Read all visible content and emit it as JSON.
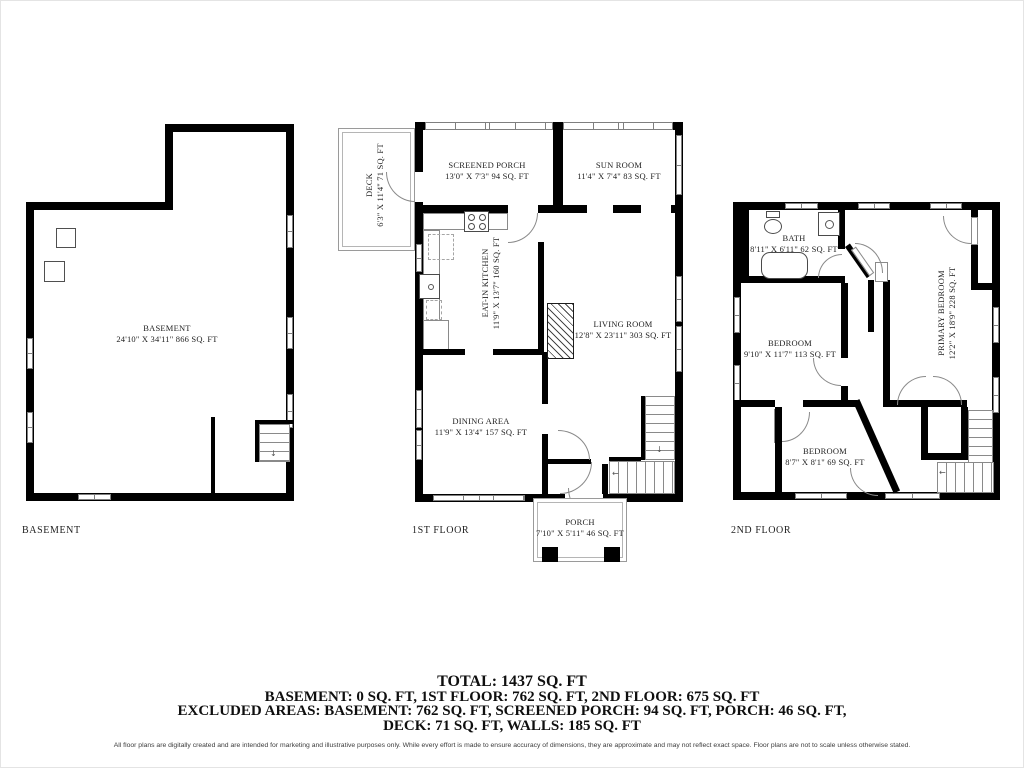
{
  "colors": {
    "wall": "#000000",
    "window_frame": "#7f7f7f",
    "text": "#1f1f1f"
  },
  "plans": {
    "basement": {
      "caption": "BASEMENT",
      "room": {
        "name": "BASEMENT",
        "dims": "24'10\" X 34'11\" 866 SQ. FT"
      }
    },
    "first_floor": {
      "caption": "1ST FLOOR",
      "rooms": {
        "deck": {
          "name": "DECK",
          "dims": "6'3\" X 11'4\" 71 SQ. FT"
        },
        "screened_porch": {
          "name": "SCREENED PORCH",
          "dims": "13'0\" X 7'3\" 94 SQ. FT"
        },
        "sun_room": {
          "name": "SUN ROOM",
          "dims": "11'4\" X 7'4\" 83 SQ. FT"
        },
        "kitchen": {
          "name": "EAT-IN KITCHEN",
          "dims": "11'9\" X 13'7\" 160 SQ. FT"
        },
        "living_room": {
          "name": "LIVING ROOM",
          "dims": "12'8\" X 23'11\" 303 SQ. FT"
        },
        "dining_area": {
          "name": "DINING AREA",
          "dims": "11'9\" X 13'4\" 157 SQ. FT"
        },
        "porch": {
          "name": "PORCH",
          "dims": "7'10\" X 5'11\" 46 SQ. FT"
        }
      }
    },
    "second_floor": {
      "caption": "2ND FLOOR",
      "rooms": {
        "bath": {
          "name": "BATH",
          "dims": "8'11\" X 6'11\" 62 SQ. FT"
        },
        "bedroom_left": {
          "name": "BEDROOM",
          "dims": "9'10\" X 11'7\" 113 SQ. FT"
        },
        "primary_bedroom": {
          "name": "PRIMARY BEDROOM",
          "dims": "12'2\" X 18'9\" 228 SQ. FT"
        },
        "bedroom_bottom": {
          "name": "BEDROOM",
          "dims": "8'7\" X 8'1\" 69 SQ. FT"
        }
      }
    }
  },
  "glyphs": {
    "down_arrow": "↓",
    "left_arrow": "←"
  },
  "summary": {
    "total": "TOTAL: 1437 SQ. FT",
    "floors": "BASEMENT: 0 SQ. FT, 1ST FLOOR: 762 SQ. FT, 2ND FLOOR: 675 SQ. FT",
    "excluded_1": "EXCLUDED AREAS: BASEMENT: 762 SQ. FT, SCREENED PORCH: 94 SQ. FT, PORCH: 46 SQ. FT,",
    "excluded_2": "DECK: 71 SQ. FT, WALLS: 185 SQ. FT",
    "disclaimer": "All floor plans are digitally created and are intended for marketing and illustrative purposes only. While every effort is made to ensure accuracy of dimensions, they are approximate and may not reflect exact space. Floor plans are not to scale unless otherwise stated."
  }
}
